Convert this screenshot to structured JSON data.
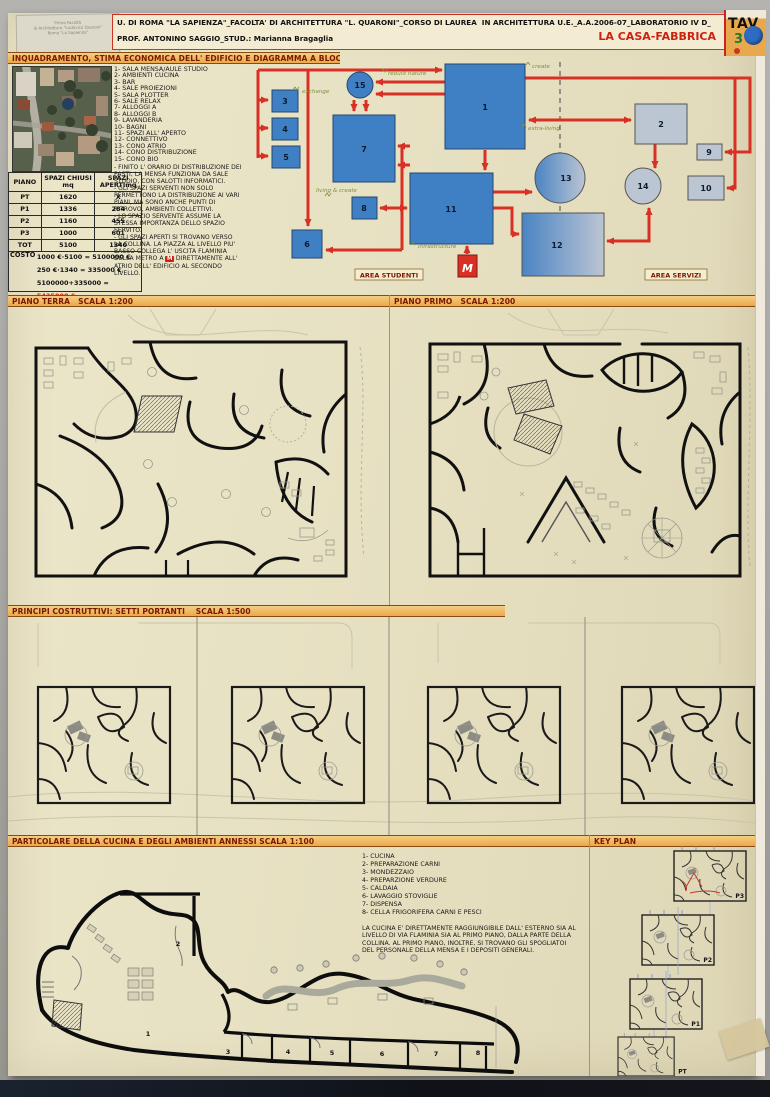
{
  "palette": {
    "board_cream": "#e8e2c4",
    "bar_orange": "#eaa948",
    "accent_red": "#d93025",
    "title_red": "#cc2211",
    "diagram_blue": "#3f7fc4",
    "diagram_gray": "#bcc5d2",
    "green_label": "#7d8f3e",
    "dark_strip": "#14151b"
  },
  "sticker": {
    "line1": "Prima Facoltà",
    "line2": "di Architettura \"Ludovico Quaroni\"",
    "line3": "Roma \"La Sapienza\""
  },
  "header": {
    "line1": "U. DI ROMA \"LA SAPIENZA\"_FACOLTA' DI ARCHITETTURA \"L. QUARONI\"_CORSO DI LAUREA  IN ARCHITETTURA U.E._A.A.2006-07_LABORATORIO IV D_",
    "line2": "PROF. ANTONINO SAGGIO_STUD.: Marianna Bragaglia",
    "project": "LA CASA-FABBRICA",
    "tav": "TAV",
    "tav_number": "3"
  },
  "section1": {
    "title": "INQUADRAMENTO, STIMA ECONOMICA DELL' EDIFICIO E DIAGRAMMA A BLOCCHI",
    "legend": [
      "1- SALA MENSA/AULE STUDIO",
      "2- AMBIENTI CUCINA",
      "3- BAR",
      "4- SALE PROIEZIONI",
      "5- SALA PLOTTER",
      "6- SALE RELAX",
      "7- ALLOGGI A",
      "8- ALLOGGI B",
      "9- LAVANDERIA",
      "10- BAGNI",
      "11- SPAZI ALL' APERTO",
      "12- CONNETTIVO",
      "13- CONO ATRIO",
      "14- CONO DISTRIBUZIONE",
      "15- CONO BIO"
    ],
    "notes": [
      "- FINITO L' ORARIO DI DISTRIBUZIONE DEI PASTI, LA MENSA FUNZIONA DA SALE STUDIO, CON SALOTTI INFORMATICI.",
      "- GLI SPAZI SERVENTI NON SOLO PERMETTONO LA DISTRIBUZIONE AI VARI PIANI, MA SONO ANCHE PUNTI DI RITROVO, AMBIENTI COLLETTIVI.",
      "- LO SPAZIO SERVENTE ASSUME LA STESSA IMPORTANZA DELLO SPAZIO SERVITO."
    ],
    "note3_a": "- GLI SPAZI APERTI SI TROVANO VERSO LA COLLINA. LA PIAZZA AL LIVELLO PIU' BASSO COLLEGA L' USCITA FLAMINIA DELLA METRO A",
    "metro": "M",
    "note3_b": "DIRETTAMENTE ALL' ATRIO DELL' EDIFICIO AL SECONDO LIVELLO.",
    "table": {
      "headers": [
        "PIANO",
        "SPAZI CHIUSI mq",
        "SPAZI APERTImq"
      ],
      "rows": [
        [
          "PT",
          "1620",
          "X"
        ],
        [
          "P1",
          "1336",
          "284"
        ],
        [
          "P2",
          "1160",
          "455"
        ],
        [
          "P3",
          "1000",
          "601"
        ],
        [
          "TOT",
          "5100",
          "1340"
        ]
      ]
    },
    "costo": {
      "label": "COSTO",
      "line1": "1000 €·5100 = 5100000 €",
      "line2": "250 €·1340 = 335000 €",
      "line3": "5100000+335000 =",
      "total": "5435000 €"
    },
    "diagram": {
      "nodes": [
        "1",
        "2",
        "3",
        "4",
        "5",
        "6",
        "7",
        "8",
        "9",
        "10",
        "11",
        "12",
        "13",
        "14",
        "15"
      ],
      "labels": {
        "exchange": "exchange",
        "rebuilt": "rebuilt nature",
        "create": "create",
        "extra": "extra-living",
        "living": "living & create",
        "infrastructure": "infrastructure",
        "metro": "M"
      },
      "area_left": "AREA STUDENTI",
      "area_right": "AREA SERVIZI"
    }
  },
  "section2": {
    "title_left": "PIANO TERRA   SCALA 1:200",
    "title_right": "PIANO PRIMO   SCALA 1:200"
  },
  "section3": {
    "title": "PRINCIPI COSTRUTTIVI: SETTI PORTANTI    SCALA 1:500"
  },
  "section4": {
    "title": "PARTICOLARE DELLA CUCINA E DEGLI AMBIENTI ANNESSI SCALA 1:100",
    "key_plan_title": "KEY PLAN",
    "legend": [
      "1- CUCINA",
      "2- PREPARAZIONE CARNI",
      "3- MONDEZZAIO",
      "4- PREPARZIONE VERDURE",
      "5- CALDAIA",
      "6- LAVAGGIO STOVIGLIE",
      "7- DISPENSA",
      "8- CELLA FRIGORIFERA CARNI E PESCI"
    ],
    "note": "LA CUCINA E' DIRETTAMENTE RAGGIUNGIBILE DALL' ESTERNO SIA AL LIVELLO DI VIA FLAMINIA SIA AL PRIMO PIANO, DALLA PARTE DELLA COLLINA. AL PRIMO PIANO, INOLTRE, SI TROVANO GLI SPOGLIATOI DEL PERSONALE DELLA MENSA E I DEPOSITI GENERALI.",
    "rooms": [
      "1",
      "2",
      "3",
      "4",
      "5",
      "6",
      "7",
      "8"
    ],
    "key_plans": [
      "P3",
      "P2",
      "P1",
      "PT"
    ]
  }
}
